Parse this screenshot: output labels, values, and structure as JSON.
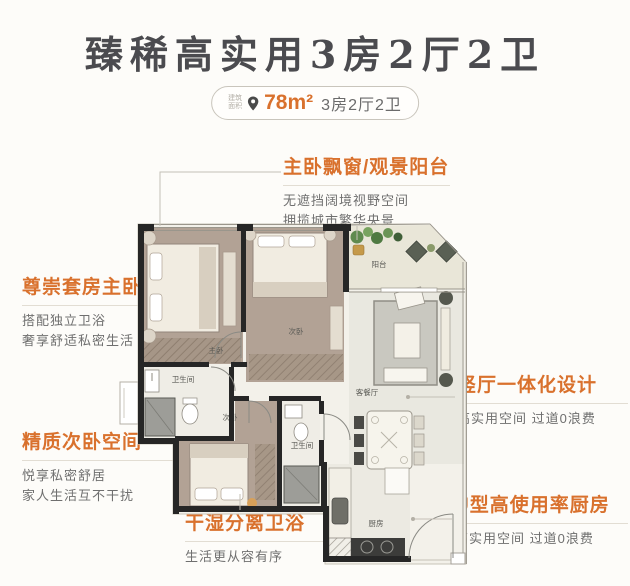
{
  "page": {
    "background": "#fdfcf9",
    "accent_color": "#d9712d"
  },
  "header": {
    "title": "臻稀高实用3房2厅2卫",
    "badge": {
      "area_prefix_top": "建筑",
      "area_prefix_bottom": "面积",
      "area_value": "78m²",
      "layout_text": "3房2厅2卫"
    }
  },
  "annotations": {
    "master_bay_window": {
      "heading": "主卧飘窗/观景阳台",
      "line1": "无遮挡阔境视野空间",
      "line2": "拥揽城市繁华央景"
    },
    "master_suite": {
      "heading": "尊崇套房主卧",
      "line1": "搭配独立卫浴",
      "line2": "奢享舒适私密生活"
    },
    "second_bedroom": {
      "heading": "精质次卧空间",
      "line1": "悦享私密舒居",
      "line2": "家人生活互不干扰"
    },
    "bathroom": {
      "heading": "干湿分离卫浴",
      "line1": "生活更从容有序"
    },
    "living_hall": {
      "heading": "竖厅一体化设计",
      "line1": "高实用空间 过道0浪费"
    },
    "kitchen": {
      "heading": "U型高使用率厨房",
      "line1": "高实用空间 过道0浪费"
    }
  },
  "floorplan": {
    "rooms": {
      "master_bedroom": "主卧",
      "bedroom2": "次卧",
      "balcony": "阳台",
      "living_dining": "客餐厅",
      "bathroom1": "卫生间",
      "bedroom3": "次卧",
      "bathroom2": "卫生间",
      "kitchen": "厨房"
    }
  }
}
